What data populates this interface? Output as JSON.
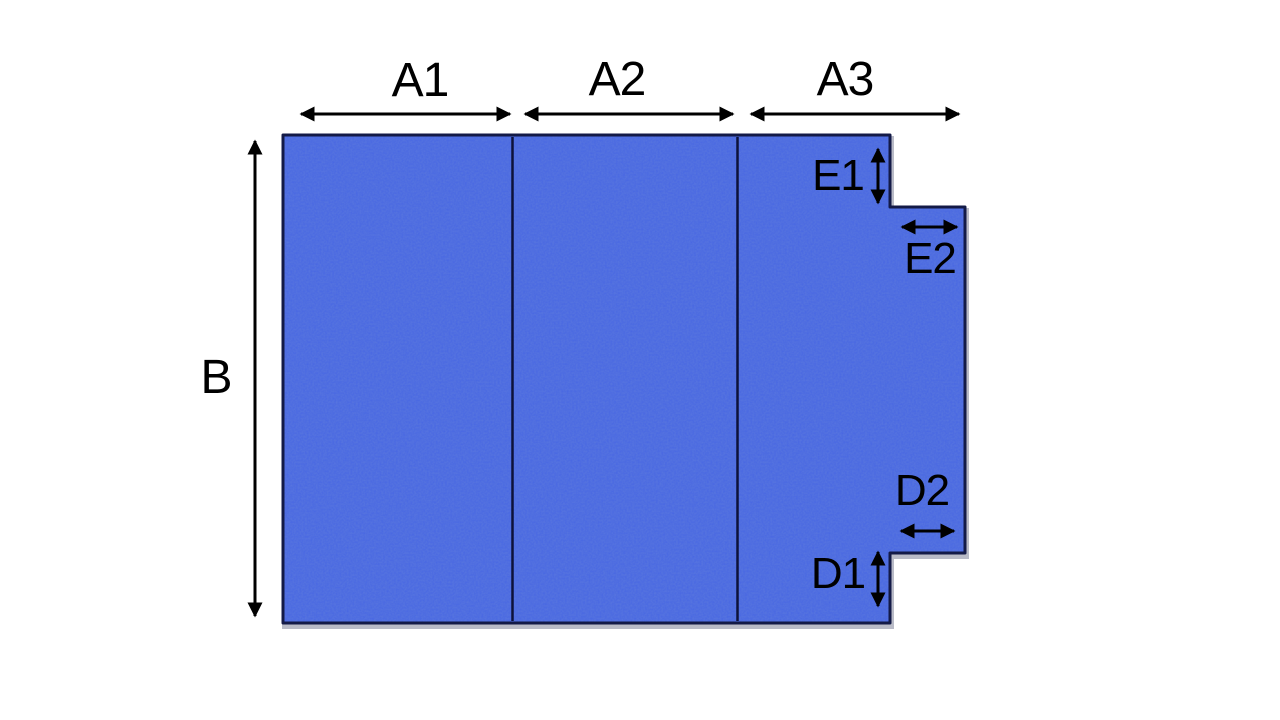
{
  "diagram": {
    "type": "fabric-panel-dimension-diagram",
    "labels": {
      "a1": "A1",
      "a2": "A2",
      "a3": "A3",
      "b": "B",
      "e1": "E1",
      "e2": "E2",
      "d1": "D1",
      "d2": "D2"
    },
    "colors": {
      "background": "#ffffff",
      "fabric_base": "#4766e3",
      "fabric_weave_dark": "#2740b0",
      "outline": "#131a47",
      "fold_line": "#0d123a",
      "arrow": "#000000",
      "label_text": "#000000"
    }
  }
}
